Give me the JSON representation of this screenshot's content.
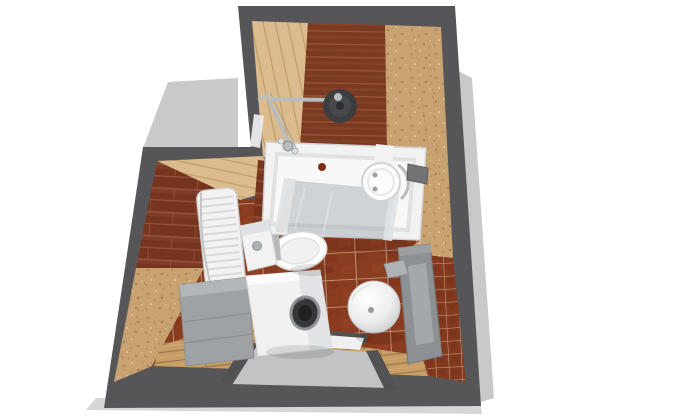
{
  "scene": {
    "title": "3D top-down render of a small bathroom floor plan"
  },
  "colors": {
    "bg": "#ffffff",
    "shadow": "#c9c9c9",
    "shadow_soft": "#d6d6d6",
    "wall": "#565659",
    "wall_edge": "#4a4a4d",
    "plank_red": "#7a3a22",
    "plank_red_line": "#a05c38",
    "plank_tan": "#dcbc8e",
    "plank_tan_line": "#c09a66",
    "cork": "#c9a271",
    "cork_dot": "#a87e4e",
    "cork_dot_light": "#e3c697",
    "brick": "#76341e",
    "brick_line": "#94543a",
    "mosaic": "#82391f",
    "mosaic_grout": "#c9ab8c",
    "tile": "#8a3c20",
    "tile_grout": "#cdb092",
    "wood": "#c79e66",
    "wood_line": "#9a7547",
    "fixture_white": "#f2f2f3",
    "fixture_stroke": "#d2d3d4",
    "tub_inner": "#f8f8f9",
    "cabinet": "#9fa2a4",
    "cabinet_light": "#b3b6b8",
    "cabinet_dark": "#8a8d8f",
    "vanity": "#8e9193",
    "vanity_panel": "#a5a8aa",
    "chrome": "#b7bcbf",
    "chrome_dark": "#9aa0a3",
    "head_dark": "#3b3d3f",
    "head_mid": "#46484b",
    "head_core": "#2c2e30",
    "porthole": "#35373a",
    "porthole_inner": "#1f2123",
    "porthole_ring": "#8f9395",
    "glass": "#96a0a6",
    "glass_bar": "#dfe2e4",
    "mat_gray": "#c2c3c4",
    "rail_dark": "#515254",
    "threshold": "#f0f0f1",
    "red_dot": "#7e2c18",
    "dome_edge": "#c2c2c2",
    "niche": "#717375"
  },
  "objects": [
    {
      "label": "Bathtub"
    },
    {
      "label": "Shower head"
    },
    {
      "label": "Shower mixer"
    },
    {
      "label": "Glass shower screen"
    },
    {
      "label": "Towel radiator"
    },
    {
      "label": "Toilet"
    },
    {
      "label": "Storage cabinet"
    },
    {
      "label": "Washing machine"
    },
    {
      "label": "Washbasin"
    },
    {
      "label": "Vanity column"
    },
    {
      "label": "Wall niche"
    },
    {
      "label": "Floor mat"
    }
  ]
}
